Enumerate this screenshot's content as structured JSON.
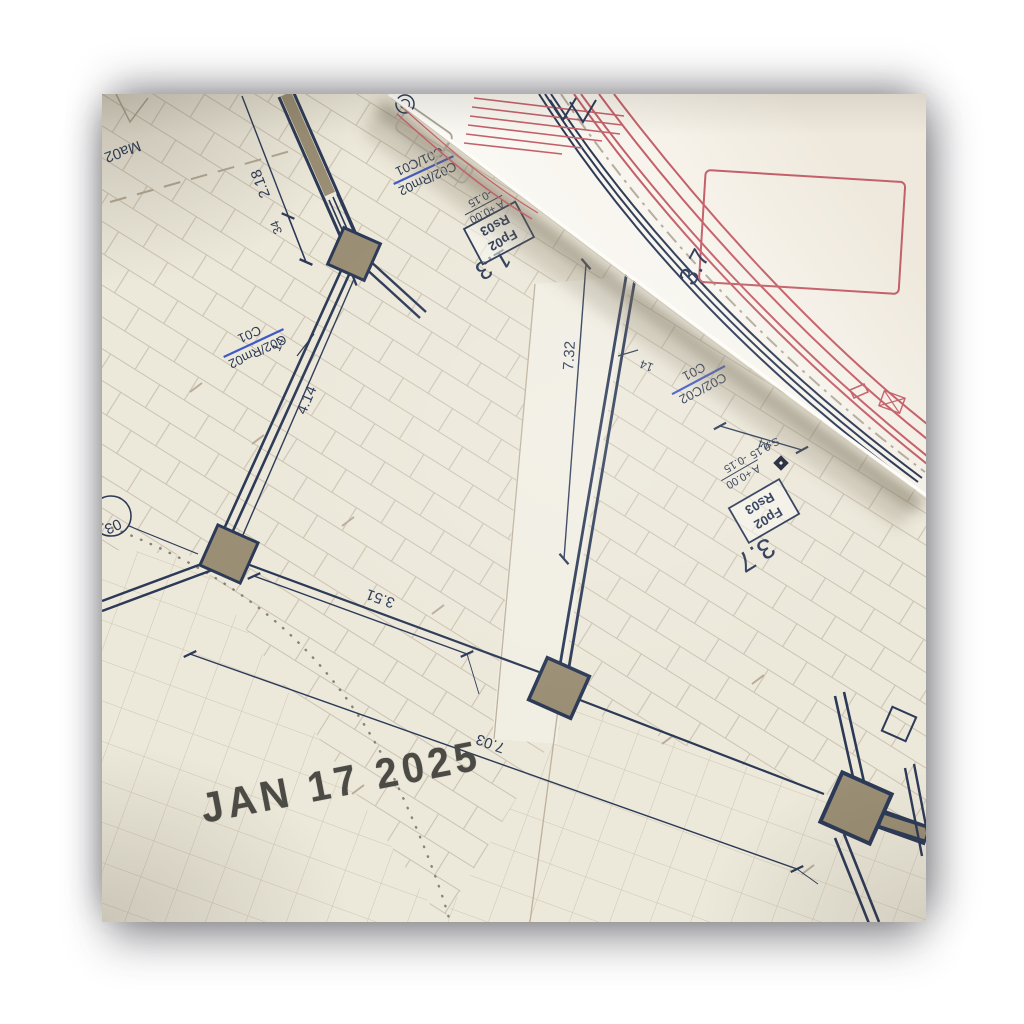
{
  "date_stamp": {
    "text": "JAN 17 2025"
  },
  "plan": {
    "labels": {
      "ma02": "Ma02",
      "grid_ref_13": "1.3",
      "grid_ref_37_sheet": "3.7",
      "grid_ref_37_curl": "3.7",
      "circle_03": "03"
    },
    "dimensions": {
      "d218": "2.18",
      "d34": "34",
      "d414": "4.14",
      "d14_left": "14",
      "d351": "3.51",
      "d732": "7.32",
      "d14_right": "14",
      "d44": "44",
      "d703": "7.03"
    },
    "door_tags": [
      {
        "line1": "C02/Rm02",
        "line2": "C01/C01"
      },
      {
        "line1": "C02/Rm02",
        "line2": "C01"
      },
      {
        "line1": "C02/C02",
        "line2": "C01"
      }
    ],
    "stamp_boxes": [
      {
        "line1": "Fp02",
        "line2": "Rs03"
      },
      {
        "line1": "Fp02",
        "line2": "Rs03"
      }
    ],
    "elevations": [
      {
        "top": "A +0.00",
        "bottom": "-0.15"
      },
      {
        "top": "A +0.00",
        "bottom": "-0.15"
      }
    ],
    "spot_level": "S.0.15"
  },
  "colors": {
    "paper": "#ece8da",
    "curl_paper": "#f8f5ee",
    "wall_navy": "#2c3a57",
    "tile_line": "#c7bcaa",
    "wall_fill_tan": "#9a8e74",
    "tag_blue": "#4059c8",
    "red_line": "#c4606a",
    "stamp_ink": "#4b4a45"
  }
}
